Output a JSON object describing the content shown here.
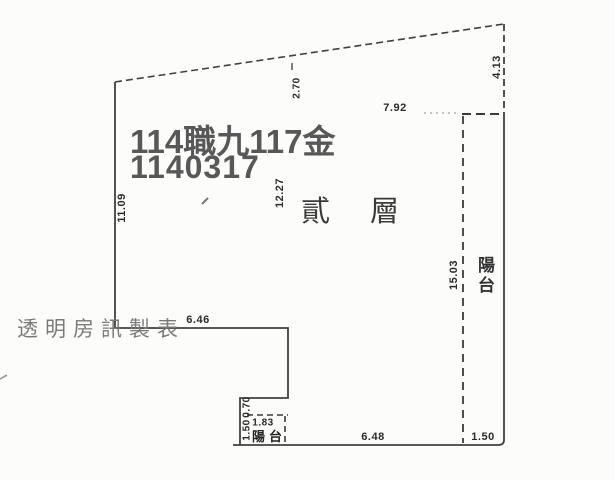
{
  "document": {
    "type": "scanned-floor-plan",
    "floor_label": "貳層",
    "balcony_label_right": "陽台",
    "balcony_label_bottom": "陽台"
  },
  "watermark": {
    "line1": "114職九117金",
    "line2": "1140317",
    "agency": "透明房訊製表"
  },
  "dimensions": {
    "left_wall": "11.09",
    "top_drop": "2.70",
    "top_span": "7.92",
    "right_top": "4.13",
    "interior_height": "12.27",
    "right_balcony_length": "15.03",
    "left_step_width": "6.46",
    "notch_depth": "0.70",
    "notch_width": "1.83",
    "notch_height": "1.50",
    "bottom_span": "6.48",
    "right_balcony_width": "1.50"
  },
  "colors": {
    "line": "#404040",
    "watermark_dark": "#585858",
    "watermark_gray": "#7a7a7a",
    "dimension_text": "#2b2b2b",
    "paper": "#fcfcfa"
  }
}
